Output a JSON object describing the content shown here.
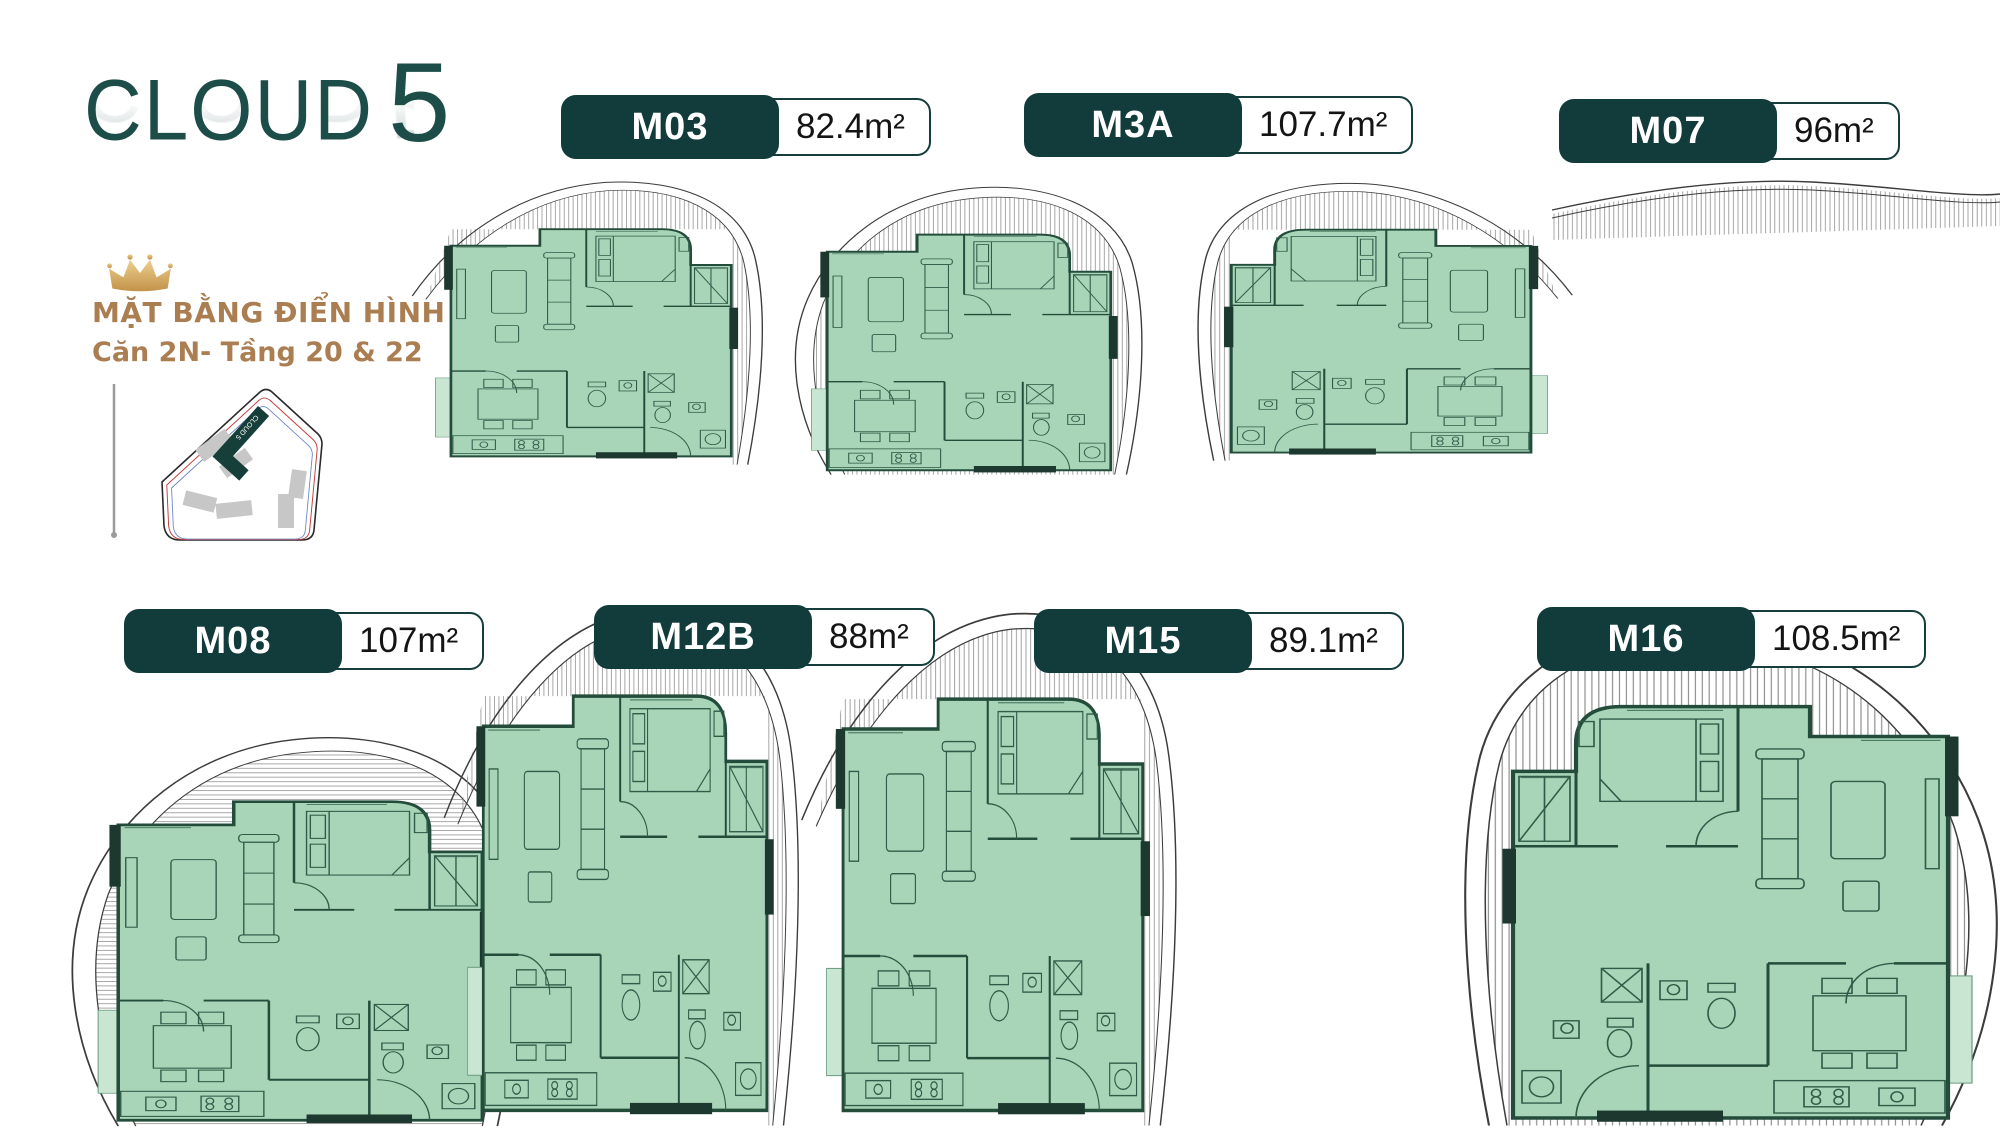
{
  "brand": {
    "name": "CLOUD",
    "number": "5"
  },
  "heading": {
    "line1": "MẶT BẰNG ĐIỂN HÌNH",
    "line2": "Căn 2N- Tầng 20 & 22"
  },
  "site_map": {
    "building_label": "CLOUD 5"
  },
  "units": [
    {
      "code": "M03",
      "area": "82.4m²"
    },
    {
      "code": "M3A",
      "area": "107.7m²"
    },
    {
      "code": "M07",
      "area": "96m²"
    },
    {
      "code": "M08",
      "area": "107m²"
    },
    {
      "code": "M12B",
      "area": "88m²"
    },
    {
      "code": "M15",
      "area": "89.1m²"
    },
    {
      "code": "M16",
      "area": "108.5m²"
    }
  ],
  "colors": {
    "badge_teal": "#123c3b",
    "logo_teal": "#1d4d48",
    "heading_brown": "#ab7e52",
    "plan_green": "#a8d5b7",
    "wall_dark": "#234c3b",
    "crown_gold": "#d8b061"
  }
}
